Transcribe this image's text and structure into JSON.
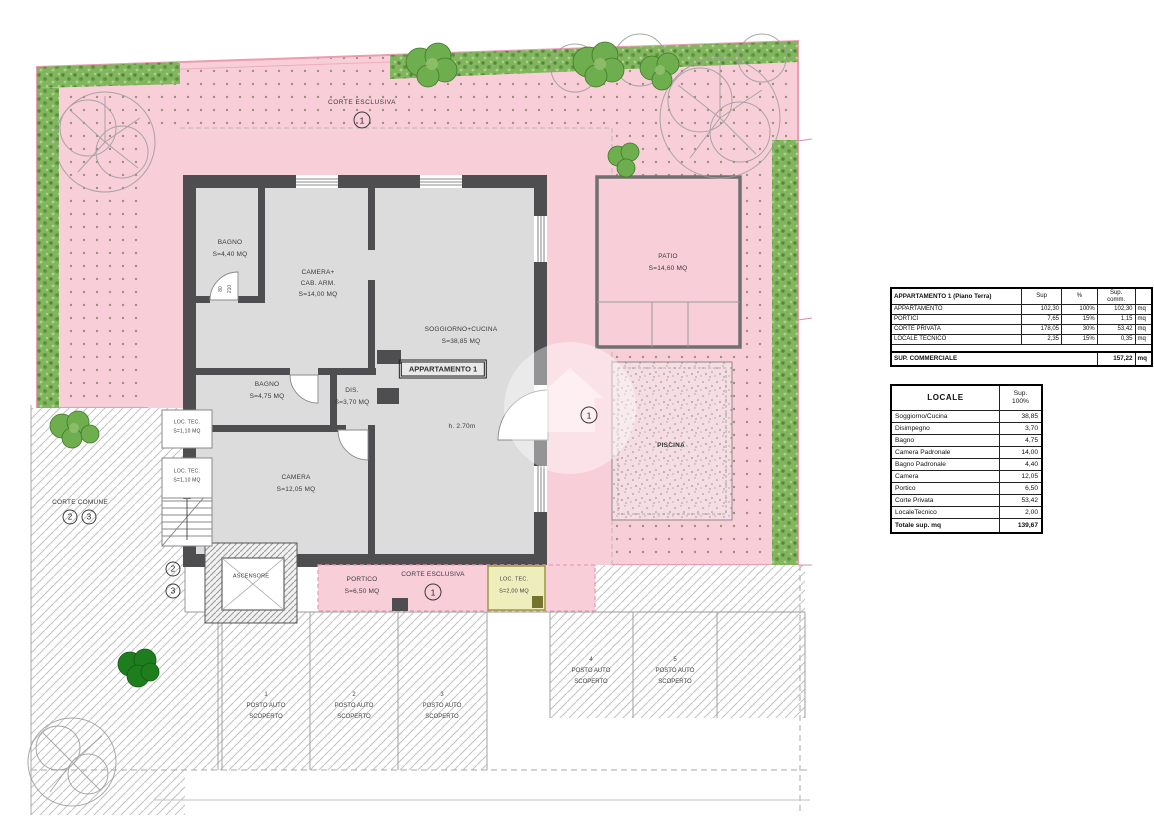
{
  "colors": {
    "courtyard_pink": "#f8cfd9",
    "boundary_pink": "#ec9cb2",
    "hedge_green": "#7cb558",
    "wall_gray": "#4e4e50",
    "floor_gray": "#dcdcdc",
    "loc_tec_yellow": "#eeeebd"
  },
  "plan": {
    "corte_esclusiva_top": {
      "label": "CORTE ESCLUSIVA",
      "number": "1"
    },
    "corte_esclusiva_bottom": {
      "label": "CORTE ESCLUSIVA",
      "number": "1"
    },
    "corte_comune": {
      "label": "CORTE COMUNE",
      "number_2": "2",
      "number_3": "3"
    },
    "entrance_number": "1",
    "stairs": {
      "number_2": "2",
      "number_3": "3"
    },
    "apartment_tag": "APPARTAMENTO 1",
    "ceiling_height": "h. 2.70m",
    "door_dimensions": {
      "width": "80",
      "height": "210"
    },
    "rooms": {
      "bagno_padronale": {
        "name": "BAGNO",
        "area": "S=4,40 MQ"
      },
      "camera_cabina": {
        "line1": "CAMERA+",
        "line2": "CAB. ARM.",
        "area": "S=14,00 MQ"
      },
      "soggiorno_cucina": {
        "name": "SOGGIORNO+CUCINA",
        "area": "S=38,85 MQ"
      },
      "bagno": {
        "name": "BAGNO",
        "area": "S=4,75 MQ"
      },
      "disimpegno": {
        "name": "DIS.",
        "area": "S=3,70 MQ"
      },
      "camera": {
        "name": "CAMERA",
        "area": "S=12,05 MQ"
      },
      "patio": {
        "name": "PATIO",
        "area": "S=14,60 MQ"
      },
      "piscina": {
        "name": "PISCINA"
      },
      "portico": {
        "name": "PORTICO",
        "area": "S=6,50 MQ"
      },
      "locale_tecnico": {
        "name": "LOC. TEC.",
        "area": "S=2,00 MQ"
      },
      "locale_tecnico_a": {
        "name": "LOC. TEC.",
        "area": "S=1,10 MQ"
      },
      "locale_tecnico_b": {
        "name": "LOC. TEC.",
        "area": "S=1,10 MQ"
      },
      "ascensore": {
        "name": "ASCENSORE"
      }
    },
    "parking": [
      {
        "num": "1",
        "line1": "POSTO AUTO",
        "line2": "SCOPERTO"
      },
      {
        "num": "2",
        "line1": "POSTO AUTO",
        "line2": "SCOPERTO"
      },
      {
        "num": "3",
        "line1": "POSTO AUTO",
        "line2": "SCOPERTO"
      },
      {
        "num": "4",
        "line1": "POSTO AUTO",
        "line2": "SCOPERTO"
      },
      {
        "num": "5",
        "line1": "POSTO AUTO",
        "line2": "SCOPERTO"
      }
    ]
  },
  "tables": {
    "apartment": {
      "title": "APPARTAMENTO 1 (Piano Terra)",
      "col_sup": "Sup",
      "col_pct": "%",
      "col_comm_1": "Sup.",
      "col_comm_2": "comm.",
      "rows": [
        {
          "label": "APPARTAMENTO",
          "sup": "102,30",
          "pct": "100%",
          "comm": "102,30",
          "unit": "mq"
        },
        {
          "label": "PORTICI",
          "sup": "7,65",
          "pct": "15%",
          "comm": "1,15",
          "unit": "mq"
        },
        {
          "label": "CORTE PRIVATA",
          "sup": "178,05",
          "pct": "30%",
          "comm": "53,42",
          "unit": "mq"
        },
        {
          "label": "LOCALE TECNICO",
          "sup": "2,35",
          "pct": "15%",
          "comm": "0,35",
          "unit": "mq"
        }
      ],
      "total_label": "SUP. COMMERCIALE",
      "total_value": "157,22",
      "total_unit": "mq"
    },
    "locale": {
      "title": "LOCALE",
      "col_sup_1": "Sup.",
      "col_sup_2": "100%",
      "rows": [
        {
          "label": "Soggiorno/Cucina",
          "value": "38,85"
        },
        {
          "label": "Disimpegno",
          "value": "3,70"
        },
        {
          "label": "Bagno",
          "value": "4,75"
        },
        {
          "label": "Camera Padronale",
          "value": "14,00"
        },
        {
          "label": "Bagno Padronale",
          "value": "4,40"
        },
        {
          "label": "Camera",
          "value": "12,05"
        },
        {
          "label": "Portico",
          "value": "6,50"
        },
        {
          "label": "Corte Privata",
          "value": "53,42"
        },
        {
          "label": "LocaleTecnico",
          "value": "2,00"
        }
      ],
      "total_label": "Totale sup. mq",
      "total_value": "139,67"
    }
  }
}
